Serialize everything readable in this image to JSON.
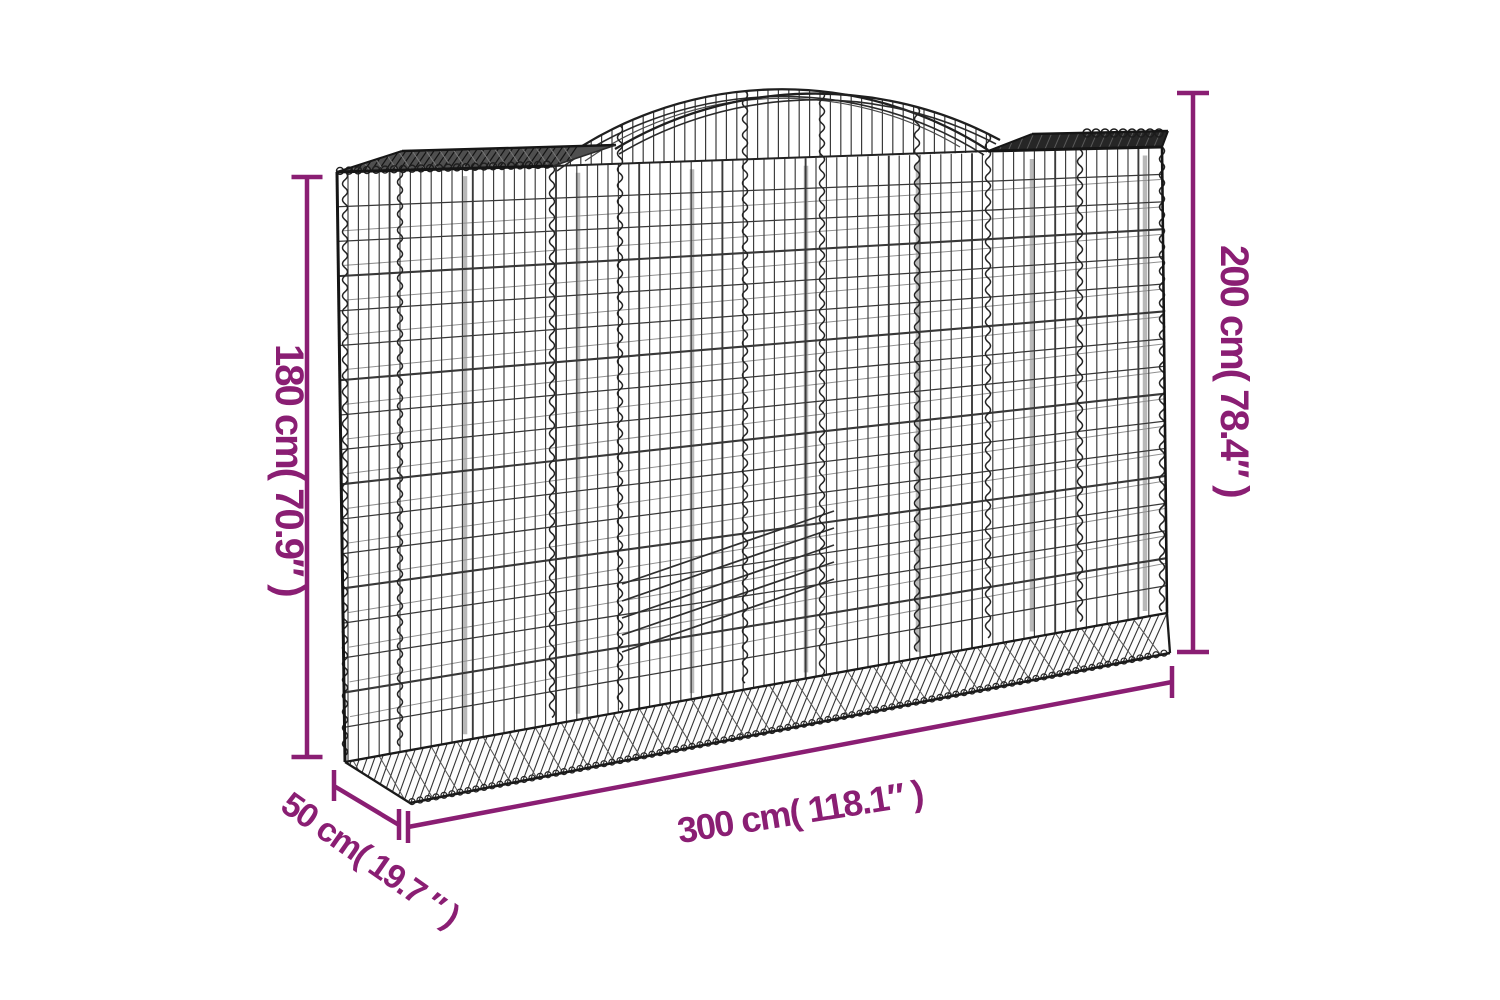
{
  "diagram": {
    "type": "product-dimension-diagram",
    "subject": "arched gabion wire mesh basket",
    "background_color": "#ffffff",
    "accent_color": "#8a1e73",
    "wire_color_dark": "#1a1a1a",
    "wire_color_mid": "#3a3a3a",
    "wire_color_light": "#b8b8b8",
    "labels": {
      "height_left": "180 cm( 70.9″ )",
      "height_right": "200 cm( 78.4″ )",
      "width": "300 cm( 118.1″ )",
      "depth": "50 cm( 19.7 ″ )"
    }
  }
}
